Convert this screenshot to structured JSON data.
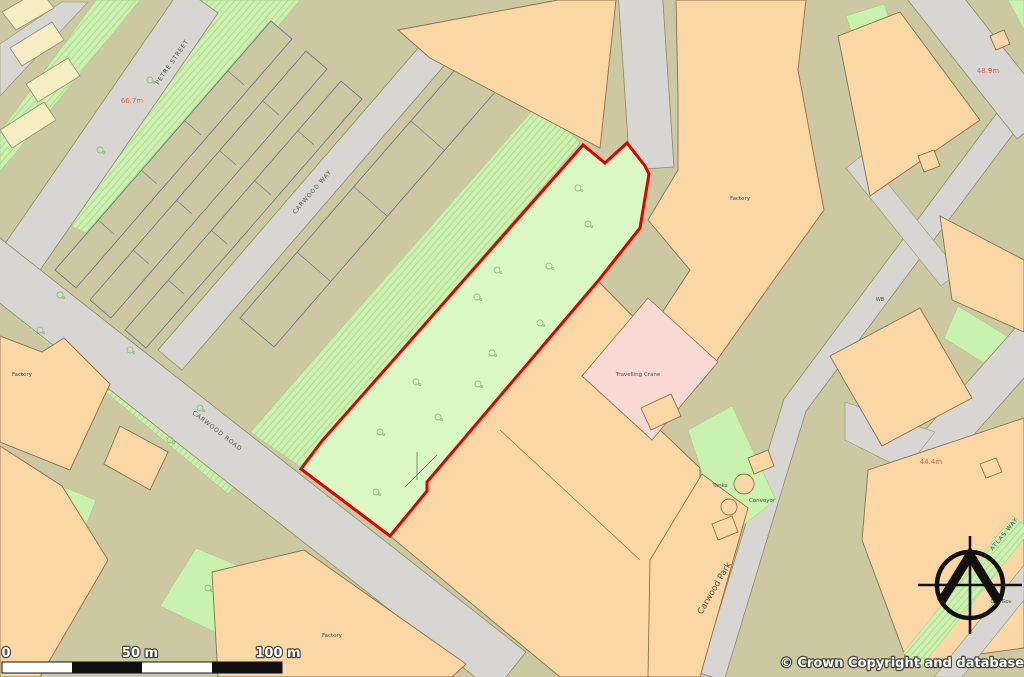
{
  "map": {
    "copyright": "© Crown Copyright and database rights 2026 OS AC0000829429",
    "scale_bar": {
      "start": "0",
      "middle": "50 m",
      "end": "100 m"
    },
    "spot_heights": {
      "northwest": "66.7m",
      "northeast": "48.9m",
      "east": "44.4m"
    },
    "streets": {
      "petre_street": "PETRE STREET",
      "carwood_way": "CARWOOD WAY",
      "carwood_road": "CARWOOD ROAD",
      "atlas_way": "ATLAS WAY"
    },
    "places": {
      "factory_west": "Factory",
      "factory_main": "Factory",
      "factory_south": "Factory",
      "travelling_crane": "Travelling Crane",
      "tanks": "Tanks",
      "conveyor": "Conveyor",
      "carwood_park": "Carwood Park",
      "weighbridge": "WB",
      "gas_governor": "Gas Gov"
    },
    "colors": {
      "boundary_red": "#e10000",
      "site_green": "#d9f8c4",
      "building_peach": "#fcd7a6",
      "road_grey": "#d7d6d2",
      "land_tan": "#ccc9a2",
      "open_green": "#cdf0b2",
      "crane_pink": "#f8d9d3",
      "spot_height_red": "#d95f55"
    }
  }
}
